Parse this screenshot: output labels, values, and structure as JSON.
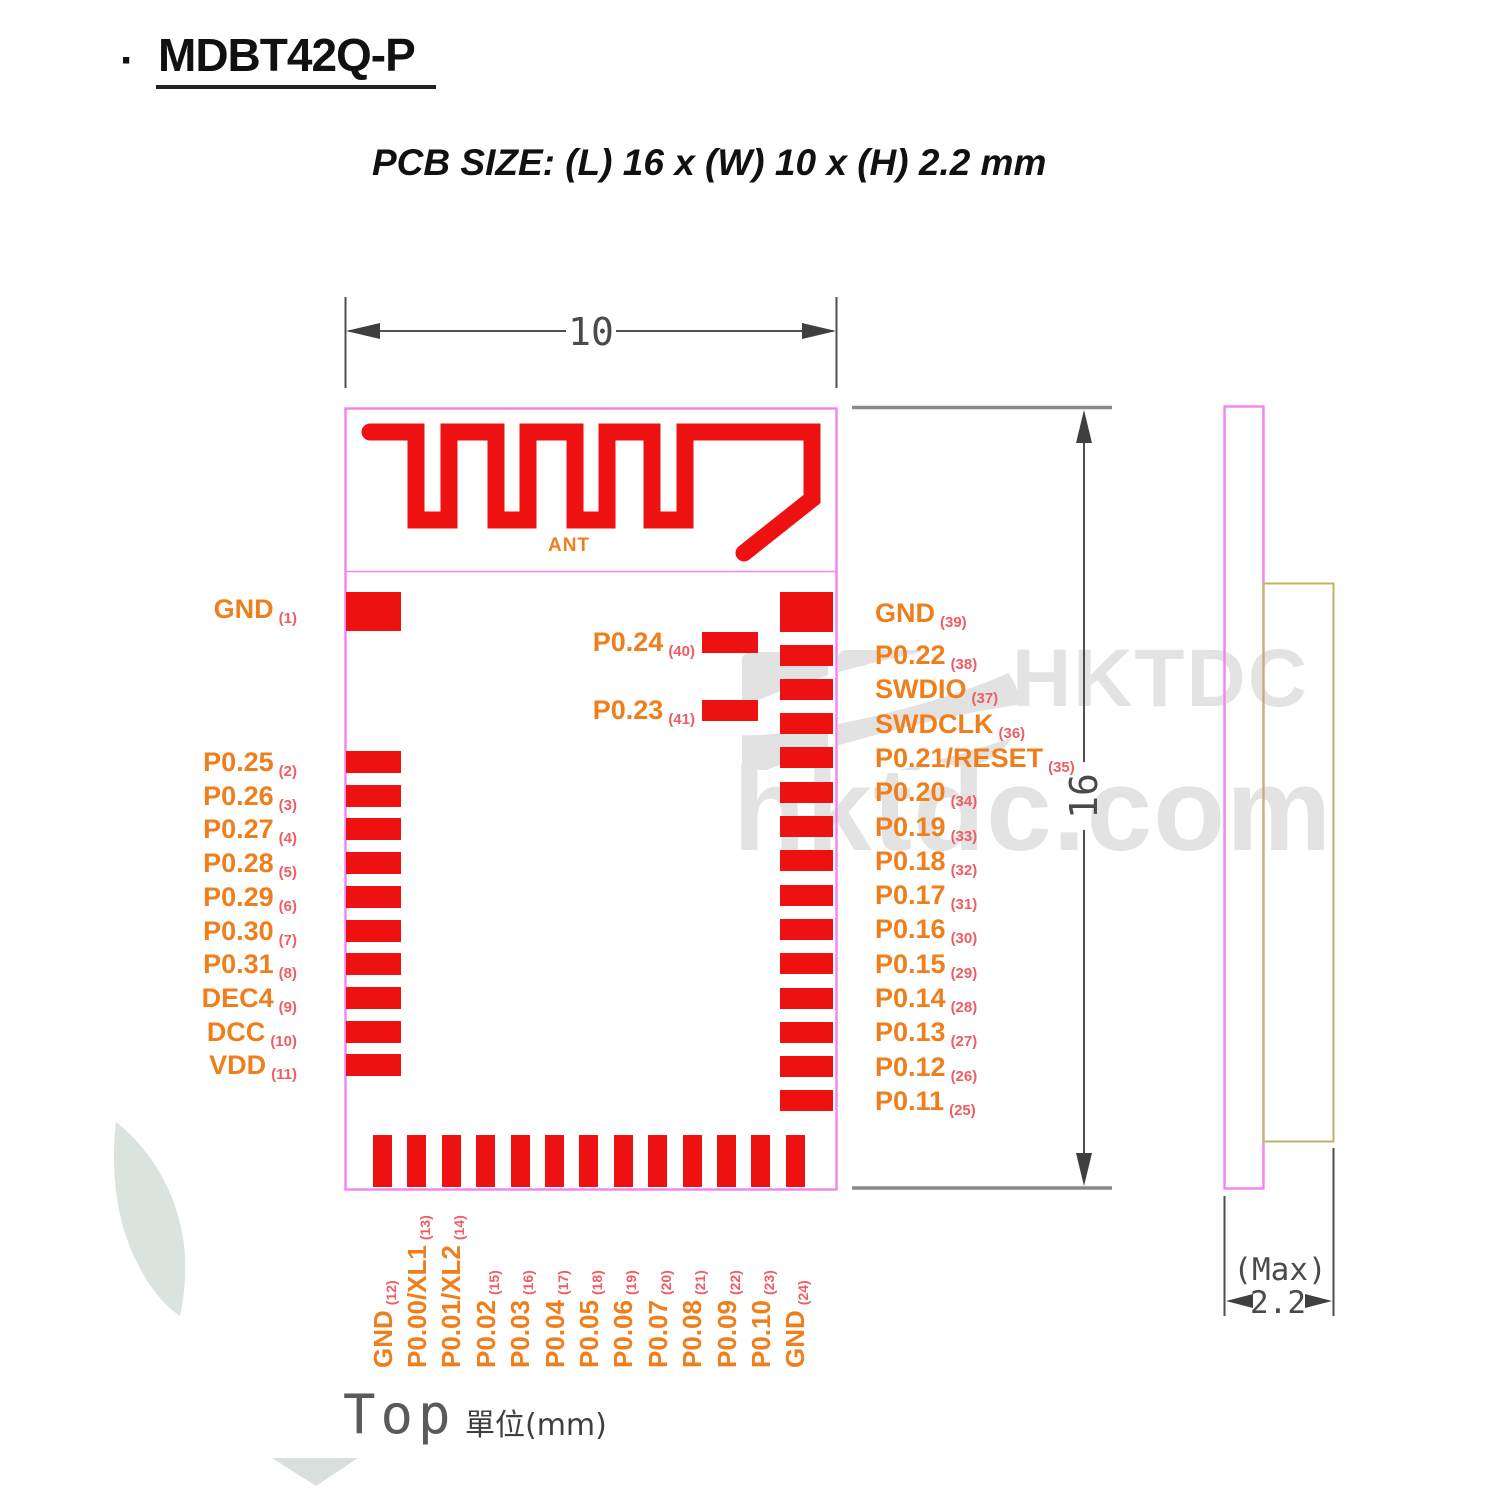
{
  "title": {
    "bullet": "·",
    "text": "MDBT42Q-P"
  },
  "subtitle": "PCB SIZE: (L) 16 x (W) 10 x (H) 2.2 mm",
  "dimensions": {
    "width": "10",
    "height": "16",
    "thickness": "2.2",
    "thickness_qualifier": "(Max)"
  },
  "labels": {
    "antenna": "ANT",
    "view": "Top",
    "units": "單位(mm)"
  },
  "watermark": {
    "logo": "HKTDC",
    "domain": "hktdc.com"
  },
  "colors": {
    "pad_red": "#ee1111",
    "outline_pink": "#f283ef",
    "label_orange": "#ef7f1d",
    "pin_number_pink": "#f05c64",
    "dimension_gray": "#4a4a4a",
    "shield_olive": "#bdb65e",
    "watermark_gray": "#e3e3e3"
  },
  "pins": {
    "left": [
      {
        "name": "GND",
        "num": "(1)"
      },
      {
        "name": "P0.25",
        "num": "(2)"
      },
      {
        "name": "P0.26",
        "num": "(3)"
      },
      {
        "name": "P0.27",
        "num": "(4)"
      },
      {
        "name": "P0.28",
        "num": "(5)"
      },
      {
        "name": "P0.29",
        "num": "(6)"
      },
      {
        "name": "P0.30",
        "num": "(7)"
      },
      {
        "name": "P0.31",
        "num": "(8)"
      },
      {
        "name": "DEC4",
        "num": "(9)"
      },
      {
        "name": "DCC",
        "num": "(10)"
      },
      {
        "name": "VDD",
        "num": "(11)"
      }
    ],
    "right": [
      {
        "name": "GND",
        "num": "(39)"
      },
      {
        "name": "P0.22",
        "num": "(38)"
      },
      {
        "name": "SWDIO",
        "num": "(37)"
      },
      {
        "name": "SWDCLK",
        "num": "(36)"
      },
      {
        "name": "P0.21/RESET",
        "num": "(35)"
      },
      {
        "name": "P0.20",
        "num": "(34)"
      },
      {
        "name": "P0.19",
        "num": "(33)"
      },
      {
        "name": "P0.18",
        "num": "(32)"
      },
      {
        "name": "P0.17",
        "num": "(31)"
      },
      {
        "name": "P0.16",
        "num": "(30)"
      },
      {
        "name": "P0.15",
        "num": "(29)"
      },
      {
        "name": "P0.14",
        "num": "(28)"
      },
      {
        "name": "P0.13",
        "num": "(27)"
      },
      {
        "name": "P0.12",
        "num": "(26)"
      },
      {
        "name": "P0.11",
        "num": "(25)"
      }
    ],
    "inner": [
      {
        "name": "P0.24",
        "num": "(40)"
      },
      {
        "name": "P0.23",
        "num": "(41)"
      }
    ],
    "bottom": [
      {
        "name": "GND",
        "num": "(12)"
      },
      {
        "name": "P0.00/XL1",
        "num": "(13)"
      },
      {
        "name": "P0.01/XL2",
        "num": "(14)"
      },
      {
        "name": "P0.02",
        "num": "(15)"
      },
      {
        "name": "P0.03",
        "num": "(16)"
      },
      {
        "name": "P0.04",
        "num": "(17)"
      },
      {
        "name": "P0.05",
        "num": "(18)"
      },
      {
        "name": "P0.06",
        "num": "(19)"
      },
      {
        "name": "P0.07",
        "num": "(20)"
      },
      {
        "name": "P0.08",
        "num": "(21)"
      },
      {
        "name": "P0.09",
        "num": "(22)"
      },
      {
        "name": "P0.10",
        "num": "(23)"
      },
      {
        "name": "GND",
        "num": "(24)"
      }
    ]
  }
}
